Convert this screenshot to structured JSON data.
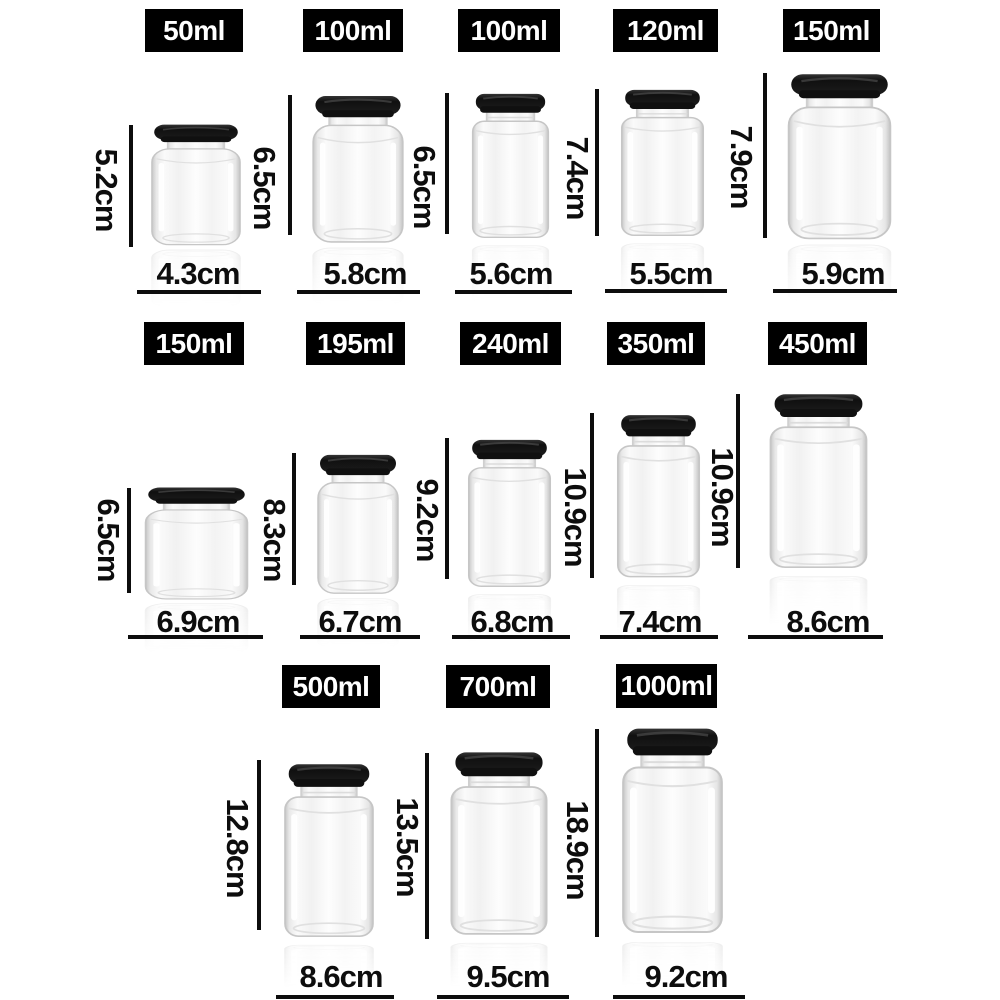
{
  "style": {
    "background": "#ffffff",
    "label_bg": "#000000",
    "label_text": "#ffffff",
    "measure_color": "#0d0d0d",
    "lid_color": "#141414",
    "glass_edge": "#c8c8c8"
  },
  "rows": [
    {
      "jars": [
        {
          "volume": "50ml",
          "height": "5.2cm",
          "width": "4.3cm"
        },
        {
          "volume": "100ml",
          "height": "6.5cm",
          "width": "5.8cm"
        },
        {
          "volume": "100ml",
          "height": "6.5cm",
          "width": "5.6cm"
        },
        {
          "volume": "120ml",
          "height": "7.4cm",
          "width": "5.5cm"
        },
        {
          "volume": "150ml",
          "height": "7.9cm",
          "width": "5.9cm"
        }
      ]
    },
    {
      "jars": [
        {
          "volume": "150ml",
          "height": "6.5cm",
          "width": "6.9cm"
        },
        {
          "volume": "195ml",
          "height": "8.3cm",
          "width": "6.7cm"
        },
        {
          "volume": "240ml",
          "height": "9.2cm",
          "width": "6.8cm"
        },
        {
          "volume": "350ml",
          "height": "10.9cm",
          "width": "7.4cm"
        },
        {
          "volume": "450ml",
          "height": "10.9cm",
          "width": "8.6cm"
        }
      ]
    },
    {
      "jars": [
        {
          "volume": "500ml",
          "height": "12.8cm",
          "width": "8.6cm"
        },
        {
          "volume": "700ml",
          "height": "13.5cm",
          "width": "9.5cm"
        },
        {
          "volume": "1000ml",
          "height": "18.9cm",
          "width": "9.2cm"
        }
      ]
    }
  ]
}
